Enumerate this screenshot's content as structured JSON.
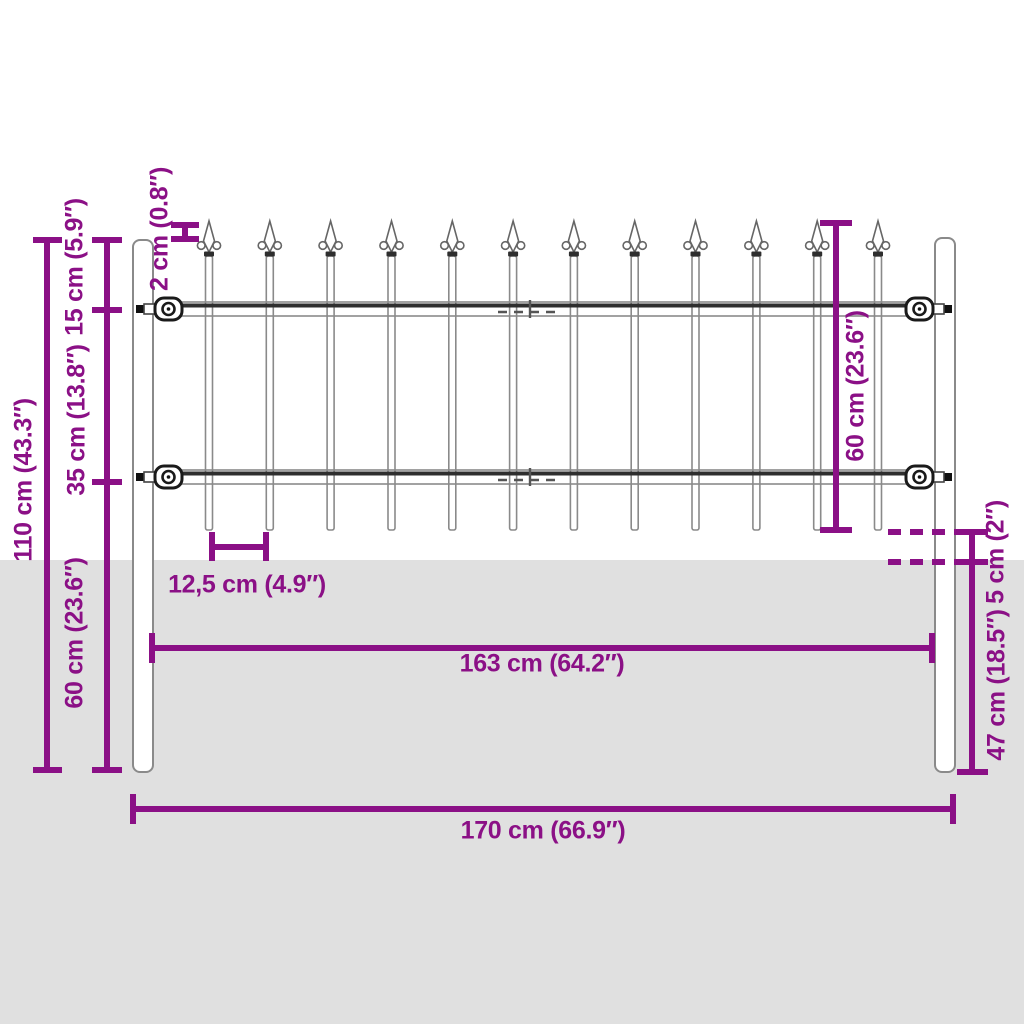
{
  "colors": {
    "accent": "#8B1086",
    "ground": "#E0E0E0",
    "steel_outline": "#8A8A8A",
    "steel_dark": "#2E2E2E"
  },
  "labels": {
    "overall_height": "110 cm (43.3″)",
    "post_top_to_rail": "15 cm (5.9″)",
    "rail_to_rail": "35 cm (13.8″)",
    "rail_to_post_bottom": "60 cm (23.6″)",
    "spear_above_post": "2 cm (0.8″)",
    "picket_spacing": "12,5 cm (4.9″)",
    "picket_height": "60 cm (23.6″)",
    "picket_above_ground": "5 cm (2″)",
    "post_below_ground": "47 cm (18.5″)",
    "inner_width": "163 cm (64.2″)",
    "overall_width": "170 cm (66.9″)"
  },
  "fence": {
    "picket_count": 12,
    "rail_count": 2,
    "post_count": 2
  }
}
